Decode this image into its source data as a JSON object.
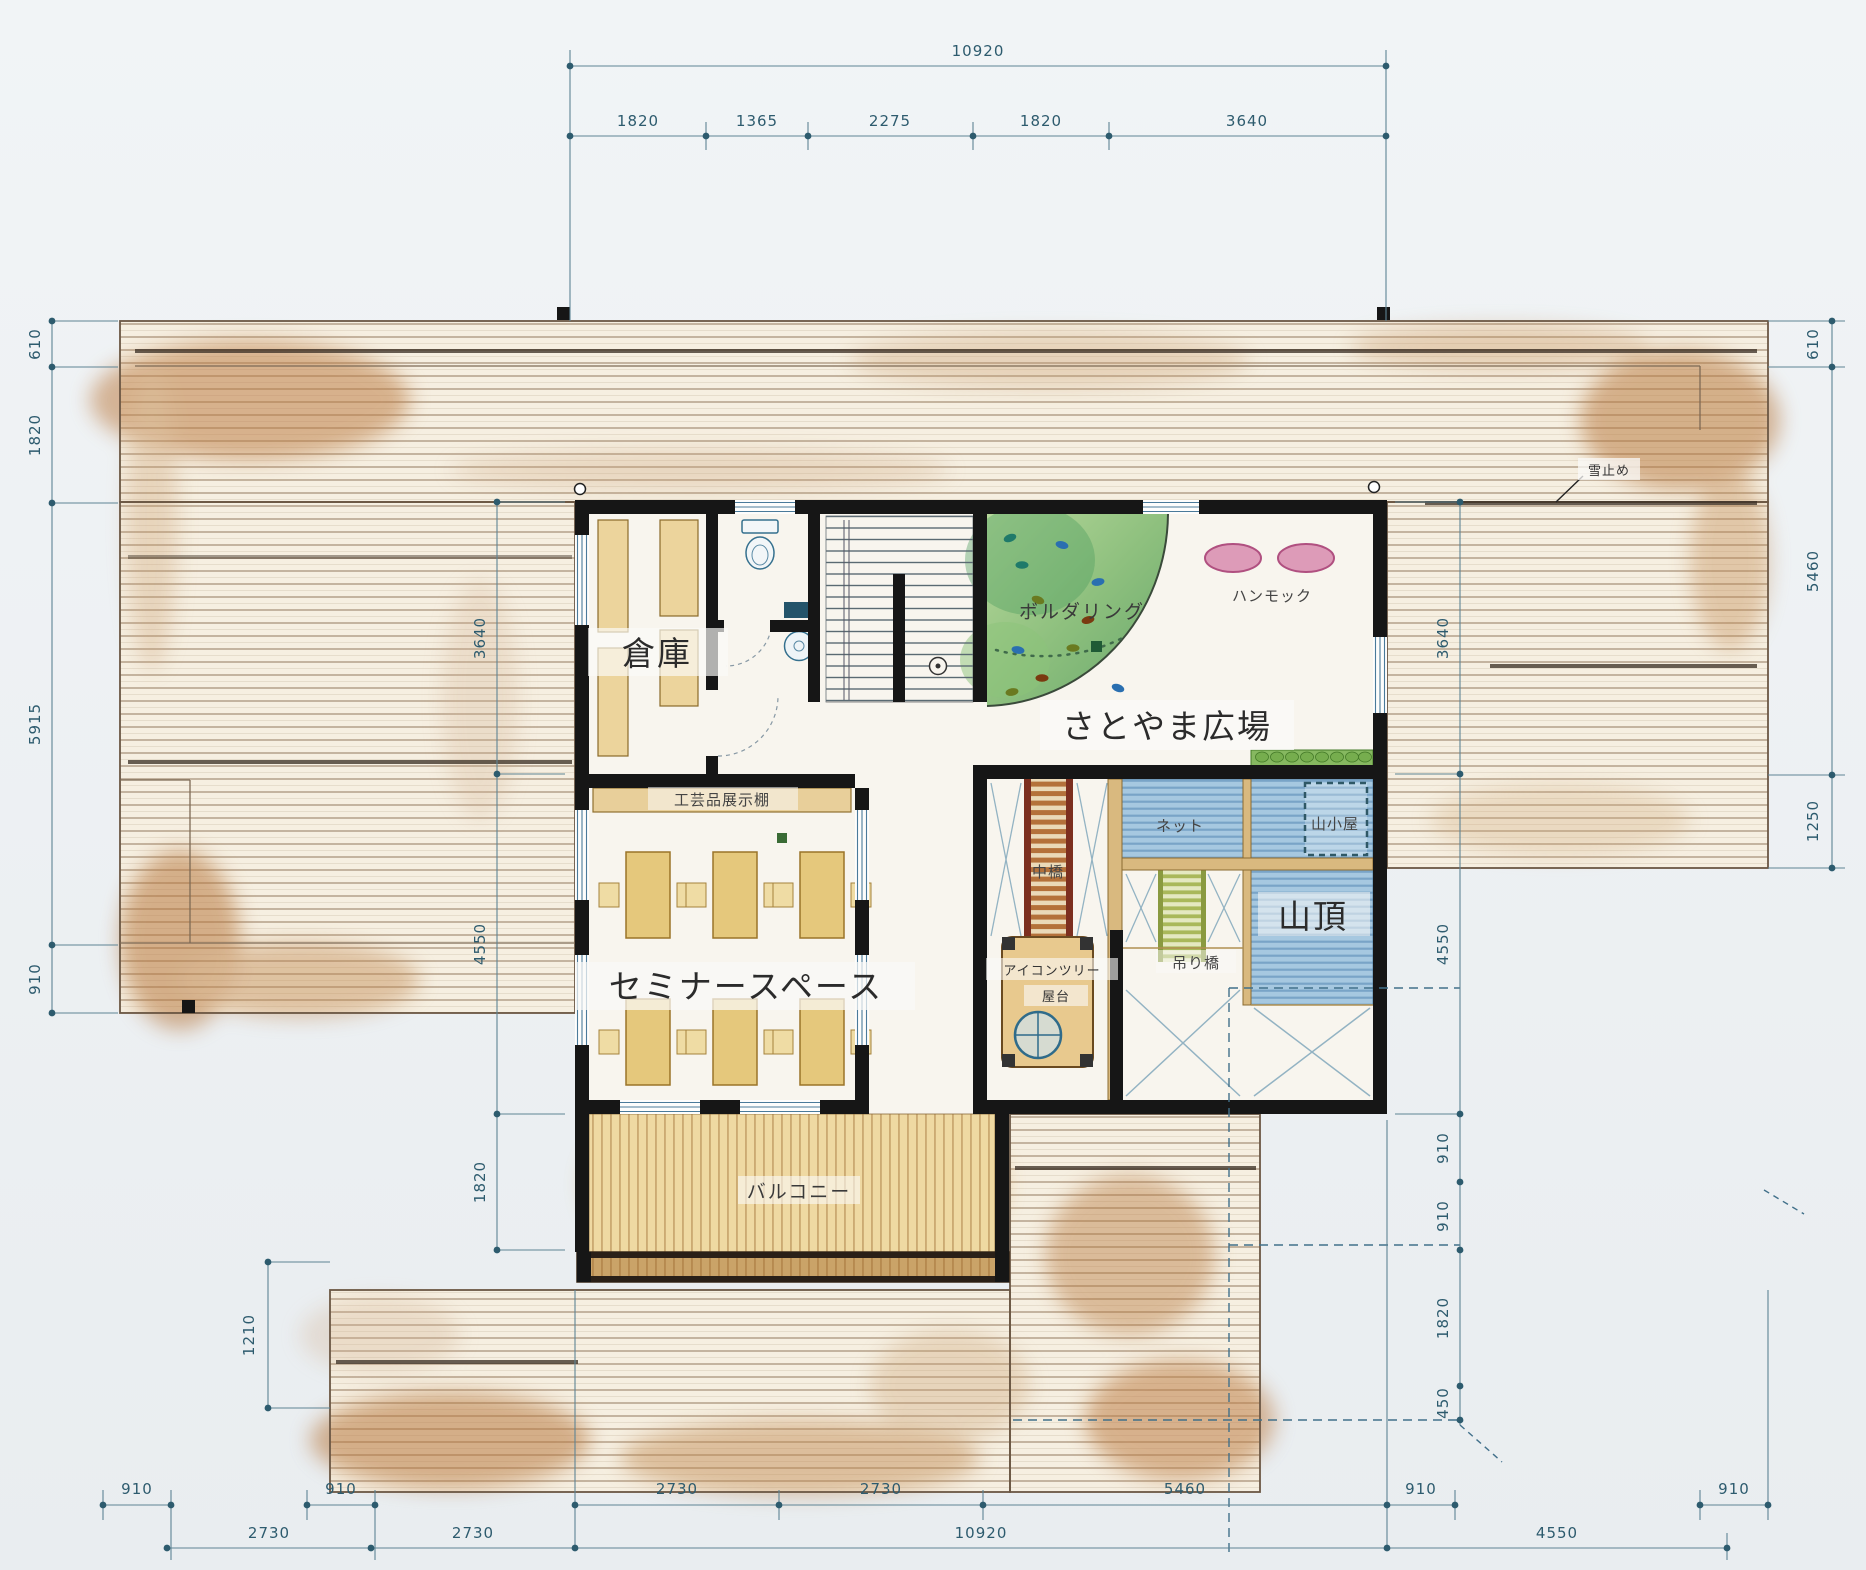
{
  "d": {
    "labels": {
      "souko": "倉庫",
      "craft_shelf": "工芸品展示棚",
      "seminar": "セミナースペース",
      "balcony": "バルコニー",
      "plaza": "さとやま広場",
      "bouldering": "ボルダリング",
      "hammock": "ハンモック",
      "middle_bridge": "中橋",
      "net": "ネット",
      "mountain_hut": "山小屋",
      "summit": "山頂",
      "suspension_bridge": "吊り橋",
      "icon_tree_line1": "アイコンツリー",
      "icon_tree_line2": "屋台",
      "snow_stop": "雪止め"
    },
    "dims": {
      "top_total": "10920",
      "top": [
        "1820",
        "1365",
        "2275",
        "1820",
        "3640"
      ],
      "left": [
        "610",
        "1820",
        "5915",
        "910"
      ],
      "left_inner": [
        "3640",
        "4550",
        "1820"
      ],
      "left_low": "1210",
      "right": [
        "610",
        "5460",
        "1250"
      ],
      "right_inner": [
        "3640",
        "4550",
        "910",
        "910",
        "1820",
        "450"
      ],
      "bottom_row1": [
        "910",
        "910",
        "2730",
        "2730",
        "5460",
        "910",
        "910"
      ],
      "bottom_row2": [
        "2730",
        "2730",
        "10920",
        "4550"
      ]
    },
    "colors": {
      "paper": "#eef1f4",
      "wall": "#161616",
      "dimension": "#2d5b6e",
      "roof_wood": "#f6efe1",
      "bouldering_green": "#68a86c",
      "play_blue": "#a6c8e0",
      "hammock_pink": "#dd9bb8",
      "furniture_tan": "#e5c87c",
      "bridge_brown": "#7c2f1f"
    }
  }
}
